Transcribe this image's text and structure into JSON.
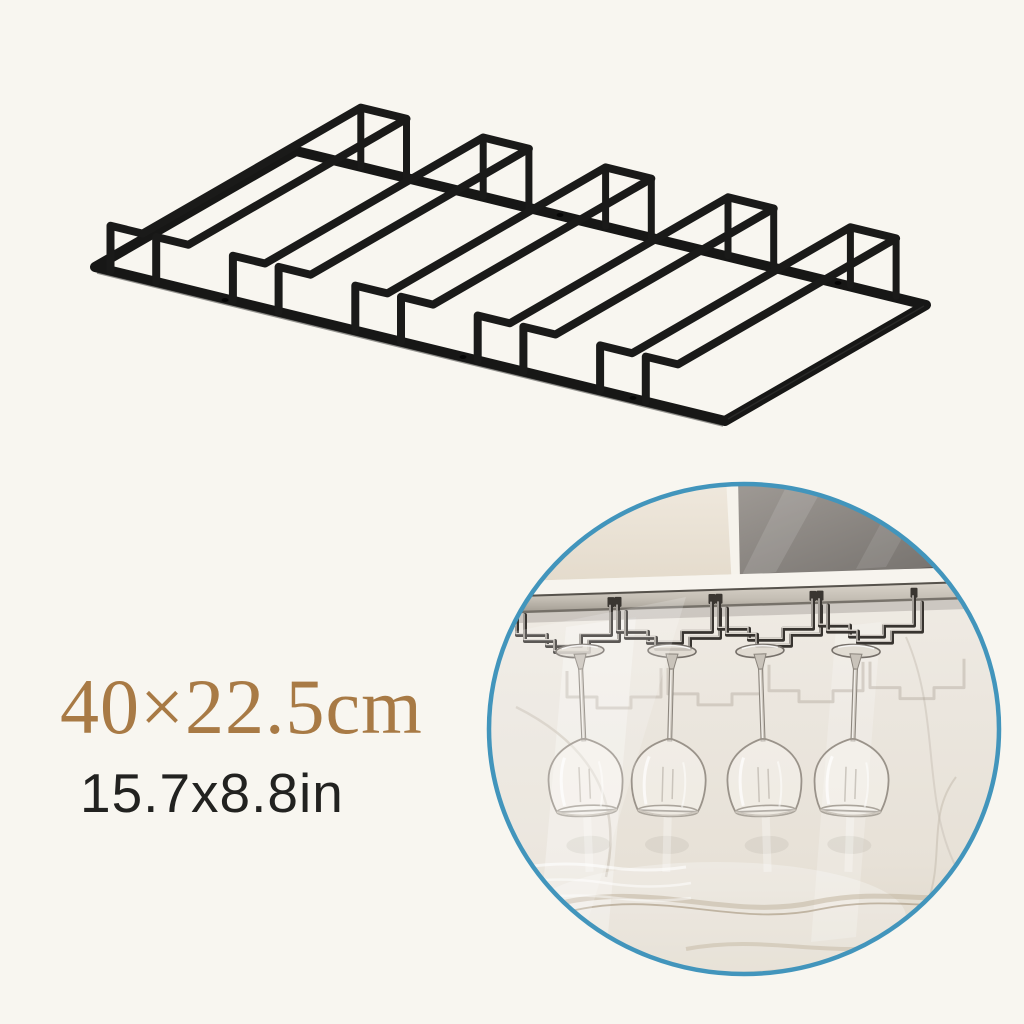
{
  "page": {
    "background_color": "#f8f6f0",
    "description": "Product image of a black metal under-cabinet stemware rack with size callouts and a circular lifestyle inset photo"
  },
  "product": {
    "name": "Under-cabinet wine glass stemware rack",
    "material_color": "#1a1a19",
    "rail_count": 5,
    "channel_count": 4
  },
  "dimensions": {
    "metric": "40×22.5cm",
    "metric_color": "#a87a45",
    "imperial": "15.7x8.8in",
    "imperial_color": "#222220"
  },
  "inset": {
    "ring_color": "#4295bc",
    "glass_count": 4,
    "scene": "Rack mounted under a kitchen cabinet holding four upside-down wine glasses against a marble wall",
    "cabinet_color": "#ece4d8",
    "glass_panel_color": "#7b7773",
    "wall_color": "#ece7df",
    "chrome_color": "#d8d2c9"
  }
}
